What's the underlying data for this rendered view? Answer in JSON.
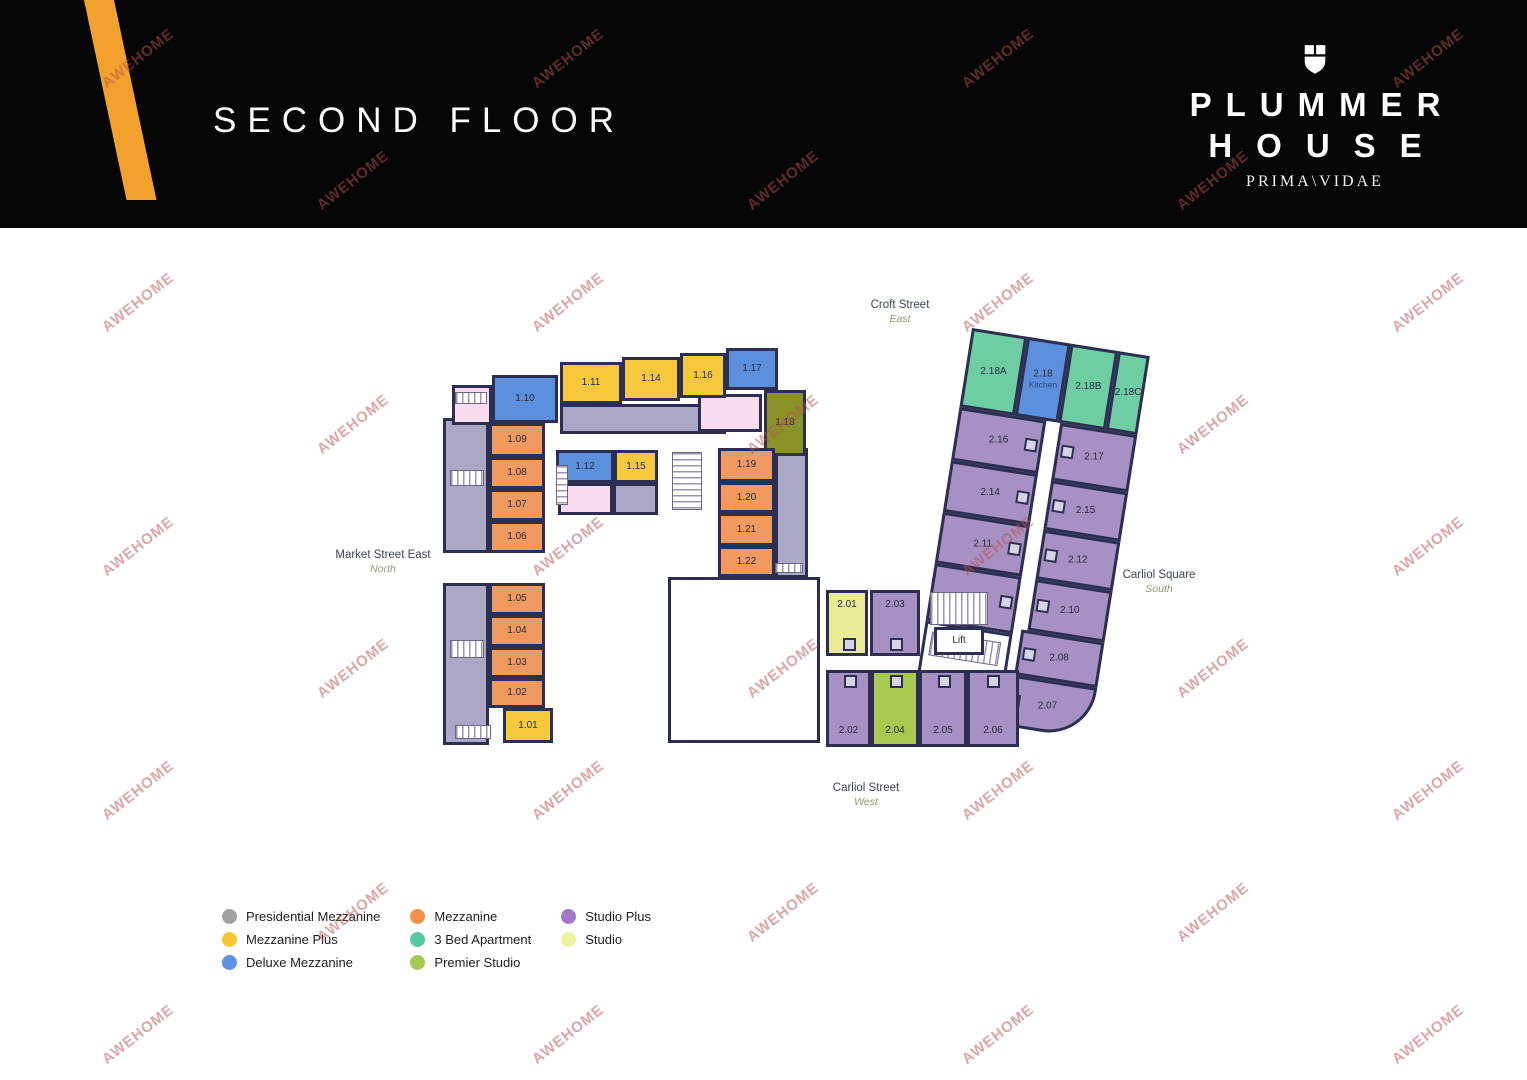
{
  "header": {
    "title": "SECOND FLOOR",
    "brand_line1": "PLUMMER",
    "brand_line2": "HOUSE",
    "brand_tagline": "PRIMA\\VIDAE"
  },
  "watermark": {
    "text": "AWEHOME"
  },
  "streets": [
    {
      "name": "Croft Street",
      "direction": "East",
      "x": 900,
      "y": 299
    },
    {
      "name": "Market Street East",
      "direction": "North",
      "x": 383,
      "y": 549
    },
    {
      "name": "Carliol Square",
      "direction": "South",
      "x": 1159,
      "y": 569
    },
    {
      "name": "Carliol Street",
      "direction": "West",
      "x": 866,
      "y": 782
    }
  ],
  "legend": {
    "columns": [
      [
        {
          "label": "Presidential Mezzanine",
          "color": "#a3a3a3"
        },
        {
          "label": "Mezzanine Plus",
          "color": "#f8c62e"
        },
        {
          "label": "Deluxe Mezzanine",
          "color": "#6191e3"
        }
      ],
      [
        {
          "label": "Mezzanine",
          "color": "#f2914d"
        },
        {
          "label": "3 Bed Apartment",
          "color": "#53cba0"
        },
        {
          "label": "Premier Studio",
          "color": "#a7c953"
        }
      ],
      [
        {
          "label": "Studio Plus",
          "color": "#a277c8"
        },
        {
          "label": "Studio",
          "color": "#eff0a0"
        }
      ]
    ]
  },
  "colors": {
    "mezz": "#F09A5F",
    "mezzplus": "#F6C93C",
    "deluxe": "#5C90DC",
    "premier": "#A9C850",
    "premierDark": "#8A9228",
    "studio": "#E9EC95",
    "splus": "#A791C4",
    "bed3": "#6FCDA4",
    "grey": "#ABA7C6",
    "pink": "#FADCF0",
    "white": "#FFFFFF",
    "wall": "#2d2f52"
  },
  "lift_label": "Lift",
  "kitchen_unit": {
    "label": "2.18",
    "sub": "Kitchen"
  },
  "rooms": [
    {
      "label": "",
      "type": "grey",
      "wing": "left",
      "x": 443,
      "y": 418,
      "w": 46,
      "h": 135
    },
    {
      "label": "",
      "type": "grey",
      "wing": "left",
      "x": 443,
      "y": 583,
      "w": 46,
      "h": 162
    },
    {
      "label": "",
      "type": "grey",
      "wing": "left",
      "x": 560,
      "y": 404,
      "w": 166,
      "h": 30
    },
    {
      "label": "",
      "type": "grey",
      "wing": "left",
      "x": 613,
      "y": 483,
      "w": 45,
      "h": 32
    },
    {
      "label": "",
      "type": "grey",
      "wing": "left",
      "x": 775,
      "y": 448,
      "w": 33,
      "h": 130
    },
    {
      "label": "",
      "type": "pink",
      "wing": "left",
      "x": 452,
      "y": 385,
      "w": 40,
      "h": 40
    },
    {
      "label": "",
      "type": "pink",
      "wing": "left",
      "x": 698,
      "y": 394,
      "w": 64,
      "h": 38
    },
    {
      "label": "",
      "type": "pink",
      "wing": "left",
      "x": 558,
      "y": 483,
      "w": 55,
      "h": 32
    },
    {
      "label": "1.10",
      "type": "deluxe",
      "wing": "left",
      "x": 492,
      "y": 375,
      "w": 66,
      "h": 48
    },
    {
      "label": "1.11",
      "type": "mezzplus",
      "wing": "left",
      "x": 560,
      "y": 362,
      "w": 62,
      "h": 42
    },
    {
      "label": "1.14",
      "type": "mezzplus",
      "wing": "left",
      "x": 622,
      "y": 357,
      "w": 58,
      "h": 44
    },
    {
      "label": "1.16",
      "type": "mezzplus",
      "wing": "left",
      "x": 680,
      "y": 353,
      "w": 46,
      "h": 45
    },
    {
      "label": "1.17",
      "type": "deluxe",
      "wing": "left",
      "x": 726,
      "y": 348,
      "w": 52,
      "h": 42
    },
    {
      "label": "1.18",
      "type": "premierDark",
      "wing": "left",
      "x": 764,
      "y": 390,
      "w": 42,
      "h": 66
    },
    {
      "label": "1.09",
      "type": "mezz",
      "wing": "left",
      "x": 489,
      "y": 423,
      "w": 56,
      "h": 34
    },
    {
      "label": "1.08",
      "type": "mezz",
      "wing": "left",
      "x": 489,
      "y": 457,
      "w": 56,
      "h": 32
    },
    {
      "label": "1.07",
      "type": "mezz",
      "wing": "left",
      "x": 489,
      "y": 489,
      "w": 56,
      "h": 32
    },
    {
      "label": "1.06",
      "type": "mezz",
      "wing": "left",
      "x": 489,
      "y": 521,
      "w": 56,
      "h": 32
    },
    {
      "label": "1.12",
      "type": "deluxe",
      "wing": "left",
      "x": 556,
      "y": 450,
      "w": 58,
      "h": 33
    },
    {
      "label": "1.15",
      "type": "mezzplus",
      "wing": "left",
      "x": 614,
      "y": 450,
      "w": 44,
      "h": 33
    },
    {
      "label": "1.19",
      "type": "mezz",
      "wing": "left",
      "x": 718,
      "y": 448,
      "w": 57,
      "h": 34
    },
    {
      "label": "1.20",
      "type": "mezz",
      "wing": "left",
      "x": 718,
      "y": 482,
      "w": 57,
      "h": 31
    },
    {
      "label": "1.21",
      "type": "mezz",
      "wing": "left",
      "x": 718,
      "y": 513,
      "w": 57,
      "h": 33
    },
    {
      "label": "1.22",
      "type": "mezz",
      "wing": "left",
      "x": 718,
      "y": 546,
      "w": 57,
      "h": 31
    },
    {
      "label": "1.05",
      "type": "mezz",
      "wing": "left",
      "x": 489,
      "y": 583,
      "w": 56,
      "h": 32
    },
    {
      "label": "1.04",
      "type": "mezz",
      "wing": "left",
      "x": 489,
      "y": 615,
      "w": 56,
      "h": 32
    },
    {
      "label": "1.03",
      "type": "mezz",
      "wing": "left",
      "x": 489,
      "y": 647,
      "w": 56,
      "h": 31
    },
    {
      "label": "1.02",
      "type": "mezz",
      "wing": "left",
      "x": 489,
      "y": 678,
      "w": 56,
      "h": 30
    },
    {
      "label": "1.01",
      "type": "mezzplus",
      "wing": "left",
      "x": 503,
      "y": 708,
      "w": 50,
      "h": 35
    },
    {
      "label": "",
      "type": "white",
      "wing": "left",
      "x": 668,
      "y": 577,
      "w": 152,
      "h": 166
    },
    {
      "label": "2.01",
      "type": "studio",
      "wing": "left",
      "x": 826,
      "y": 590,
      "w": 42,
      "h": 66,
      "lpos": "t",
      "pods": "b"
    },
    {
      "label": "2.03",
      "type": "splus",
      "wing": "left",
      "x": 870,
      "y": 590,
      "w": 50,
      "h": 66,
      "lpos": "t",
      "pods": "b"
    },
    {
      "label": "Lift",
      "type": "white",
      "wing": "left",
      "x": 934,
      "y": 627,
      "w": 50,
      "h": 28
    },
    {
      "label": "2.02",
      "type": "splus",
      "wing": "left",
      "x": 826,
      "y": 670,
      "w": 45,
      "h": 77,
      "lpos": "b",
      "pods": "t"
    },
    {
      "label": "2.04",
      "type": "premier",
      "wing": "left",
      "x": 871,
      "y": 670,
      "w": 48,
      "h": 77,
      "lpos": "b",
      "pods": "t"
    },
    {
      "label": "2.05",
      "type": "splus",
      "wing": "left",
      "x": 919,
      "y": 670,
      "w": 48,
      "h": 77,
      "lpos": "b",
      "pods": "t"
    },
    {
      "label": "2.06",
      "type": "splus",
      "wing": "left",
      "x": 967,
      "y": 670,
      "w": 52,
      "h": 77,
      "lpos": "b",
      "pods": "t"
    },
    {
      "label": "2.18A",
      "type": "bed3",
      "wing": "strip",
      "x": 0,
      "y": 0,
      "w": 56,
      "h": 80
    },
    {
      "label": "2.18",
      "sub": "Kitchen",
      "type": "deluxe",
      "wing": "strip",
      "x": 56,
      "y": 0,
      "w": 44,
      "h": 80
    },
    {
      "label": "2.18B",
      "type": "bed3",
      "wing": "strip",
      "x": 100,
      "y": 0,
      "w": 48,
      "h": 80
    },
    {
      "label": "2.18C",
      "type": "bed3",
      "wing": "strip",
      "x": 148,
      "y": 0,
      "w": 32,
      "h": 80
    },
    {
      "label": "2.16",
      "type": "splus",
      "wing": "strip",
      "x": 0,
      "y": 80,
      "w": 88,
      "h": 54,
      "pods": "r"
    },
    {
      "label": "2.14",
      "type": "splus",
      "wing": "strip",
      "x": 0,
      "y": 134,
      "w": 88,
      "h": 52,
      "pods": "r"
    },
    {
      "label": "2.11",
      "type": "splus",
      "wing": "strip",
      "x": 0,
      "y": 186,
      "w": 88,
      "h": 52,
      "pods": "r"
    },
    {
      "label": "2.09",
      "type": "splus",
      "wing": "strip",
      "x": 0,
      "y": 238,
      "w": 88,
      "h": 58,
      "pods": "r"
    },
    {
      "label": "",
      "type": "white",
      "wing": "strip",
      "x": 0,
      "y": 296,
      "w": 88,
      "h": 54
    },
    {
      "label": "2.17",
      "type": "splus",
      "wing": "strip",
      "x": 102,
      "y": 80,
      "w": 78,
      "h": 58,
      "pods": "l"
    },
    {
      "label": "2.15",
      "type": "splus",
      "wing": "strip",
      "x": 102,
      "y": 138,
      "w": 78,
      "h": 50,
      "pods": "l"
    },
    {
      "label": "2.12",
      "type": "splus",
      "wing": "strip",
      "x": 102,
      "y": 188,
      "w": 78,
      "h": 50,
      "pods": "l"
    },
    {
      "label": "2.10",
      "type": "splus",
      "wing": "strip",
      "x": 102,
      "y": 238,
      "w": 78,
      "h": 52,
      "pods": "l"
    },
    {
      "label": "2.08",
      "type": "splus",
      "wing": "strip",
      "x": 96,
      "y": 290,
      "w": 84,
      "h": 46,
      "pods": "l"
    },
    {
      "label": "2.07",
      "type": "splus",
      "wing": "strip",
      "x": 88,
      "y": 336,
      "w": 92,
      "h": 52,
      "pods": "l",
      "r": 48
    }
  ],
  "stairs": [
    {
      "wing": "left",
      "dir": "h",
      "x": 455,
      "y": 392,
      "w": 32,
      "h": 12
    },
    {
      "wing": "left",
      "dir": "v",
      "x": 556,
      "y": 465,
      "w": 12,
      "h": 40
    },
    {
      "wing": "left",
      "dir": "v",
      "x": 672,
      "y": 452,
      "w": 30,
      "h": 58
    },
    {
      "wing": "left",
      "dir": "h",
      "x": 450,
      "y": 470,
      "w": 34,
      "h": 16
    },
    {
      "wing": "left",
      "dir": "h",
      "x": 450,
      "y": 640,
      "w": 34,
      "h": 18
    },
    {
      "wing": "left",
      "dir": "h",
      "x": 455,
      "y": 725,
      "w": 36,
      "h": 14
    },
    {
      "wing": "left",
      "dir": "h",
      "x": 775,
      "y": 563,
      "w": 28,
      "h": 10
    },
    {
      "wing": "left",
      "dir": "h",
      "x": 930,
      "y": 592,
      "w": 58,
      "h": 33
    },
    {
      "wing": "strip",
      "dir": "h",
      "x": 8,
      "y": 306,
      "w": 70,
      "h": 24
    }
  ]
}
